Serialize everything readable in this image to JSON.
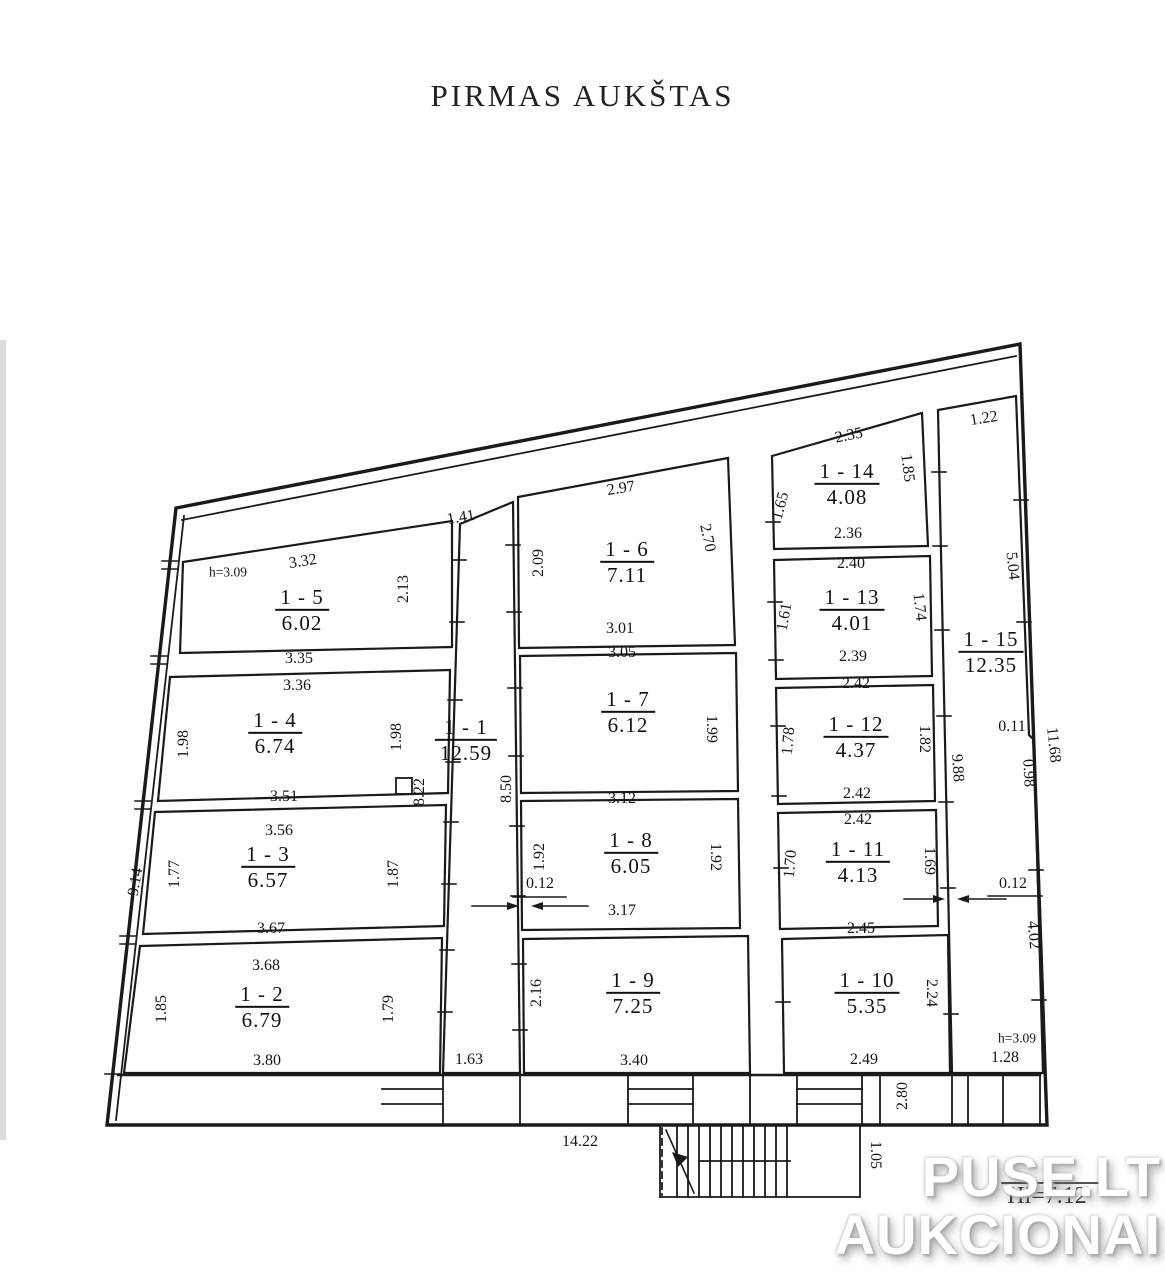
{
  "title": "PIRMAS AUKŠTAS",
  "watermark": {
    "line1": "PUSE.LT",
    "line2": "AUKCIONAI"
  },
  "colors": {
    "line": "#1a1a1a",
    "background": "#ffffff",
    "watermark_text": "#ffffff"
  },
  "plan": {
    "rooms": [
      {
        "id": "1 - 1",
        "area": "12.59",
        "x": 466,
        "y": 740,
        "r": 0
      },
      {
        "id": "1 - 2",
        "area": "6.79",
        "x": 262,
        "y": 1007,
        "r": 0
      },
      {
        "id": "1 - 3",
        "area": "6.57",
        "x": 268,
        "y": 867,
        "r": 0
      },
      {
        "id": "1 - 4",
        "area": "6.74",
        "x": 275,
        "y": 733,
        "r": 0
      },
      {
        "id": "1 - 5",
        "area": "6.02",
        "x": 302,
        "y": 610,
        "r": 0
      },
      {
        "id": "1 - 6",
        "area": "7.11",
        "x": 627,
        "y": 562,
        "r": 0
      },
      {
        "id": "1 - 7",
        "area": "6.12",
        "x": 628,
        "y": 712,
        "r": 0
      },
      {
        "id": "1 - 8",
        "area": "6.05",
        "x": 631,
        "y": 853,
        "r": 0
      },
      {
        "id": "1 - 9",
        "area": "7.25",
        "x": 633,
        "y": 993,
        "r": 0
      },
      {
        "id": "1 - 10",
        "area": "5.35",
        "x": 867,
        "y": 993,
        "r": 0
      },
      {
        "id": "1 - 11",
        "area": "4.13",
        "x": 858,
        "y": 862,
        "r": 0
      },
      {
        "id": "1 - 12",
        "area": "4.37",
        "x": 856,
        "y": 737,
        "r": 0
      },
      {
        "id": "1 - 13",
        "area": "4.01",
        "x": 852,
        "y": 610,
        "r": 0
      },
      {
        "id": "1 - 14",
        "area": "4.08",
        "x": 847,
        "y": 484,
        "r": 0
      },
      {
        "id": "1 - 15",
        "area": "12.35",
        "x": 991,
        "y": 652,
        "r": 0
      }
    ],
    "dims": [
      {
        "t": "3.32",
        "x": 303,
        "y": 562,
        "r": -9
      },
      {
        "t": "h=3.09",
        "x": 228,
        "y": 572,
        "r": 0,
        "s": 1
      },
      {
        "t": "2.13",
        "x": 404,
        "y": 589,
        "r": -90
      },
      {
        "t": "3.35",
        "x": 299,
        "y": 659,
        "r": 0
      },
      {
        "t": "3.36",
        "x": 297,
        "y": 686,
        "r": 0
      },
      {
        "t": "1.98",
        "x": 184,
        "y": 744,
        "r": -90
      },
      {
        "t": "1.98",
        "x": 397,
        "y": 737,
        "r": -90
      },
      {
        "t": "3.51",
        "x": 284,
        "y": 797,
        "r": 0
      },
      {
        "t": "3.56",
        "x": 279,
        "y": 831,
        "r": 0
      },
      {
        "t": "1.77",
        "x": 175,
        "y": 874,
        "r": -90
      },
      {
        "t": "1.87",
        "x": 394,
        "y": 874,
        "r": -90
      },
      {
        "t": "3.67",
        "x": 271,
        "y": 929,
        "r": 0
      },
      {
        "t": "3.68",
        "x": 266,
        "y": 966,
        "r": 0
      },
      {
        "t": "1.85",
        "x": 162,
        "y": 1009,
        "r": -90
      },
      {
        "t": "1.79",
        "x": 389,
        "y": 1009,
        "r": -90
      },
      {
        "t": "3.80",
        "x": 267,
        "y": 1061,
        "r": 0
      },
      {
        "t": "9.14",
        "x": 136,
        "y": 882,
        "r": -80
      },
      {
        "t": "1.41",
        "x": 461,
        "y": 518,
        "r": -9
      },
      {
        "t": "8.22",
        "x": 420,
        "y": 792,
        "r": -90
      },
      {
        "t": "8.50",
        "x": 507,
        "y": 789,
        "r": -90
      },
      {
        "t": "0.12",
        "x": 540,
        "y": 884,
        "r": 0
      },
      {
        "t": "1.63",
        "x": 469,
        "y": 1060,
        "r": 0
      },
      {
        "t": "2.97",
        "x": 621,
        "y": 489,
        "r": -9
      },
      {
        "t": "2.09",
        "x": 539,
        "y": 563,
        "r": -90
      },
      {
        "t": "2.70",
        "x": 707,
        "y": 538,
        "r": 78
      },
      {
        "t": "3.01",
        "x": 620,
        "y": 629,
        "r": 0
      },
      {
        "t": "3.05",
        "x": 622,
        "y": 653,
        "r": 0
      },
      {
        "t": "1.99",
        "x": 711,
        "y": 729,
        "r": 90
      },
      {
        "t": "3.12",
        "x": 622,
        "y": 799,
        "r": 0
      },
      {
        "t": "1.92",
        "x": 540,
        "y": 857,
        "r": -90
      },
      {
        "t": "1.92",
        "x": 715,
        "y": 857,
        "r": 90
      },
      {
        "t": "3.17",
        "x": 622,
        "y": 911,
        "r": 0
      },
      {
        "t": "2.16",
        "x": 537,
        "y": 993,
        "r": -90
      },
      {
        "t": "3.40",
        "x": 634,
        "y": 1061,
        "r": 0
      },
      {
        "t": "2.35",
        "x": 849,
        "y": 436,
        "r": -11
      },
      {
        "t": "1.65",
        "x": 781,
        "y": 506,
        "r": -75
      },
      {
        "t": "1.85",
        "x": 907,
        "y": 468,
        "r": 83
      },
      {
        "t": "2.36",
        "x": 848,
        "y": 534,
        "r": 0
      },
      {
        "t": "2.40",
        "x": 851,
        "y": 564,
        "r": 0
      },
      {
        "t": "1.61",
        "x": 785,
        "y": 617,
        "r": -80
      },
      {
        "t": "1.74",
        "x": 919,
        "y": 607,
        "r": 84
      },
      {
        "t": "2.39",
        "x": 853,
        "y": 657,
        "r": 0
      },
      {
        "t": "2.42",
        "x": 856,
        "y": 684,
        "r": 0
      },
      {
        "t": "1.78",
        "x": 789,
        "y": 741,
        "r": -85
      },
      {
        "t": "1.82",
        "x": 924,
        "y": 739,
        "r": 90
      },
      {
        "t": "2.42",
        "x": 857,
        "y": 794,
        "r": 0
      },
      {
        "t": "2.42",
        "x": 858,
        "y": 820,
        "r": 0
      },
      {
        "t": "1.70",
        "x": 791,
        "y": 864,
        "r": -85
      },
      {
        "t": "1.69",
        "x": 929,
        "y": 861,
        "r": 90
      },
      {
        "t": "2.45",
        "x": 861,
        "y": 929,
        "r": 0
      },
      {
        "t": "2.24",
        "x": 931,
        "y": 993,
        "r": 90
      },
      {
        "t": "2.49",
        "x": 864,
        "y": 1060,
        "r": 0
      },
      {
        "t": "0.12",
        "x": 1013,
        "y": 884,
        "r": 0
      },
      {
        "t": "1.22",
        "x": 984,
        "y": 419,
        "r": -9
      },
      {
        "t": "5.04",
        "x": 1012,
        "y": 566,
        "r": 84
      },
      {
        "t": "9.88",
        "x": 957,
        "y": 768,
        "r": 86
      },
      {
        "t": "0.11",
        "x": 1012,
        "y": 727,
        "r": 0
      },
      {
        "t": "0.98",
        "x": 1028,
        "y": 773,
        "r": 87
      },
      {
        "t": "11.68",
        "x": 1053,
        "y": 745,
        "r": 84
      },
      {
        "t": "4.02",
        "x": 1033,
        "y": 935,
        "r": 85
      },
      {
        "t": "h=3.09",
        "x": 1017,
        "y": 1038,
        "r": 0,
        "s": 1
      },
      {
        "t": "1.28",
        "x": 1005,
        "y": 1058,
        "r": 0
      },
      {
        "t": "14.22",
        "x": 580,
        "y": 1142,
        "r": 0
      },
      {
        "t": "1.05",
        "x": 875,
        "y": 1155,
        "r": 90
      },
      {
        "t": "2.80",
        "x": 903,
        "y": 1096,
        "r": -90
      },
      {
        "t": "Hi=7.12",
        "x": 1047,
        "y": 1196,
        "r": 0,
        "l": 1
      }
    ]
  }
}
